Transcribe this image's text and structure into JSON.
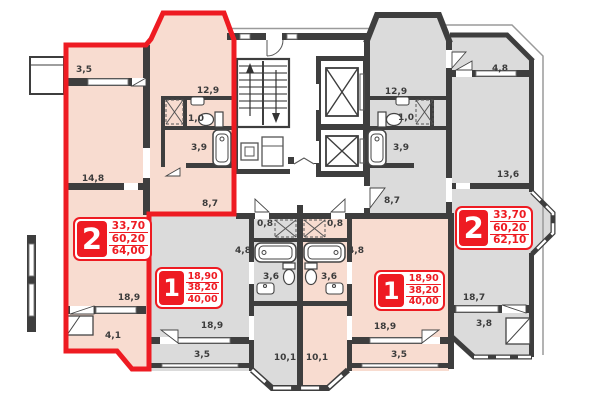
{
  "colors": {
    "highlight_red": "#ee1b22",
    "apartment_pink": "#f8dcd0",
    "apartment_gray": "#dbdbdb",
    "wall_dark": "#3e3e3e",
    "background": "#ffffff"
  },
  "icons": [
    "stairs-icon",
    "elevator-icon",
    "bathtub-icon",
    "toilet-icon",
    "sink-icon",
    "door-swing-icon",
    "wardrobe-icon",
    "trash-chute-icon",
    "window-icon",
    "closet-hatch-icon"
  ],
  "apartments": [
    {
      "id": "left-2-room",
      "type_label": "2",
      "highlighted": true,
      "areas": [
        "33,70",
        "60,20",
        "64,00"
      ],
      "rooms": [
        {
          "name": "balcony-top",
          "area": "3,5"
        },
        {
          "name": "room",
          "area": "14,8"
        },
        {
          "name": "kitchen",
          "area": "12,9"
        },
        {
          "name": "wc",
          "area": "1,0"
        },
        {
          "name": "bathroom",
          "area": "3,9"
        },
        {
          "name": "hallway",
          "area": "8,7"
        },
        {
          "name": "room",
          "area": "18,9"
        },
        {
          "name": "balcony-bottom",
          "area": "4,1"
        }
      ]
    },
    {
      "id": "center-left-1-room",
      "type_label": "1",
      "highlighted": false,
      "areas": [
        "18,90",
        "38,20",
        "40,00"
      ],
      "rooms": [
        {
          "name": "hallway",
          "area": "4,8"
        },
        {
          "name": "closet",
          "area": "0,8"
        },
        {
          "name": "bathroom",
          "area": "3,6"
        },
        {
          "name": "kitchen",
          "area": "10,1"
        },
        {
          "name": "room",
          "area": "18,9"
        },
        {
          "name": "balcony",
          "area": "3,5"
        }
      ]
    },
    {
      "id": "center-right-1-room",
      "type_label": "1",
      "highlighted": false,
      "areas": [
        "18,90",
        "38,20",
        "40,00"
      ],
      "rooms": [
        {
          "name": "hallway",
          "area": "4,8"
        },
        {
          "name": "closet",
          "area": "0,8"
        },
        {
          "name": "bathroom",
          "area": "3,6"
        },
        {
          "name": "kitchen",
          "area": "10,1"
        },
        {
          "name": "room",
          "area": "18,9"
        },
        {
          "name": "balcony",
          "area": "3,5"
        }
      ]
    },
    {
      "id": "right-2-room",
      "type_label": "2",
      "highlighted": false,
      "areas": [
        "33,70",
        "60,20",
        "62,10"
      ],
      "rooms": [
        {
          "name": "kitchen",
          "area": "12,9"
        },
        {
          "name": "wc",
          "area": "1,0"
        },
        {
          "name": "bathroom",
          "area": "3,9"
        },
        {
          "name": "hallway",
          "area": "8,7"
        },
        {
          "name": "balcony-top",
          "area": "4,8"
        },
        {
          "name": "room",
          "area": "13,6"
        },
        {
          "name": "room",
          "area": "18,7"
        },
        {
          "name": "balcony-bottom",
          "area": "3,8"
        }
      ]
    }
  ]
}
